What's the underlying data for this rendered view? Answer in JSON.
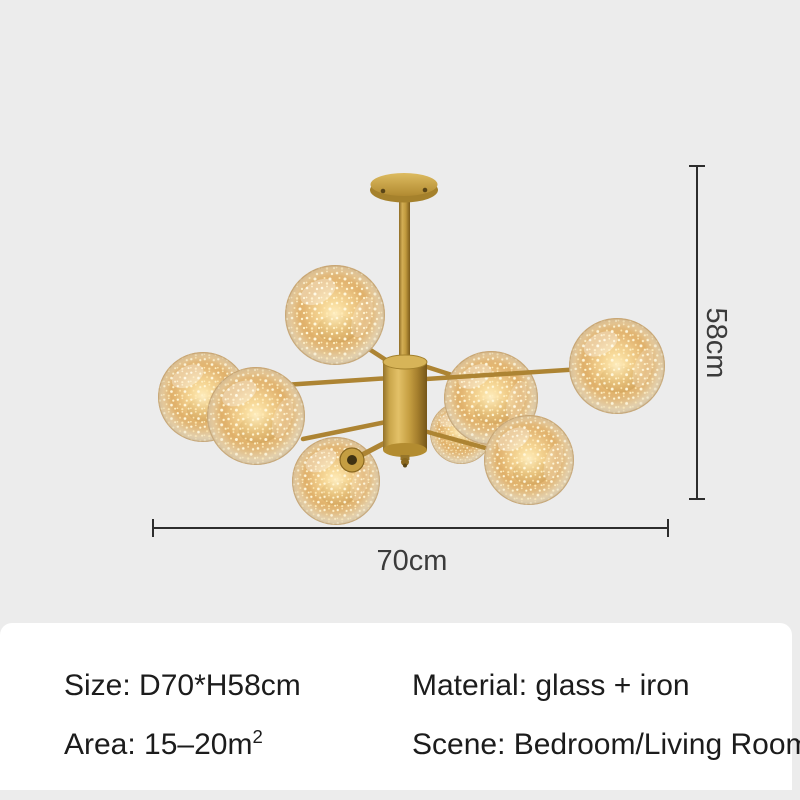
{
  "product_image": {
    "description": "Gold modern sputnik chandelier with 8 amber glass globes filled with firefly string lights, shown hanging from a ceiling canopy on a gray backdrop",
    "globe_count": 8
  },
  "dimensions": {
    "height_label": "58cm",
    "width_label": "70cm"
  },
  "specs": {
    "size": "Size: D70*H58cm",
    "material": "Material: glass + iron",
    "area_prefix": "Area: 15–20m",
    "area_superscript": "2",
    "scene": "Scene: Bedroom/Living Room"
  },
  "colors": {
    "background": "#ececec",
    "panel": "#ffffff",
    "spec_text": "#1c1c1c",
    "dimension_line": "#2d2d2d",
    "dimension_text": "#3b3b3b",
    "gold": "#c59e41",
    "gold_highlight": "#e3c168",
    "gold_shadow": "#7c5c1b",
    "glass_amber": "#e0b069",
    "glass_rim": "#d9c7a5",
    "sparkle": "#fff6d8"
  }
}
